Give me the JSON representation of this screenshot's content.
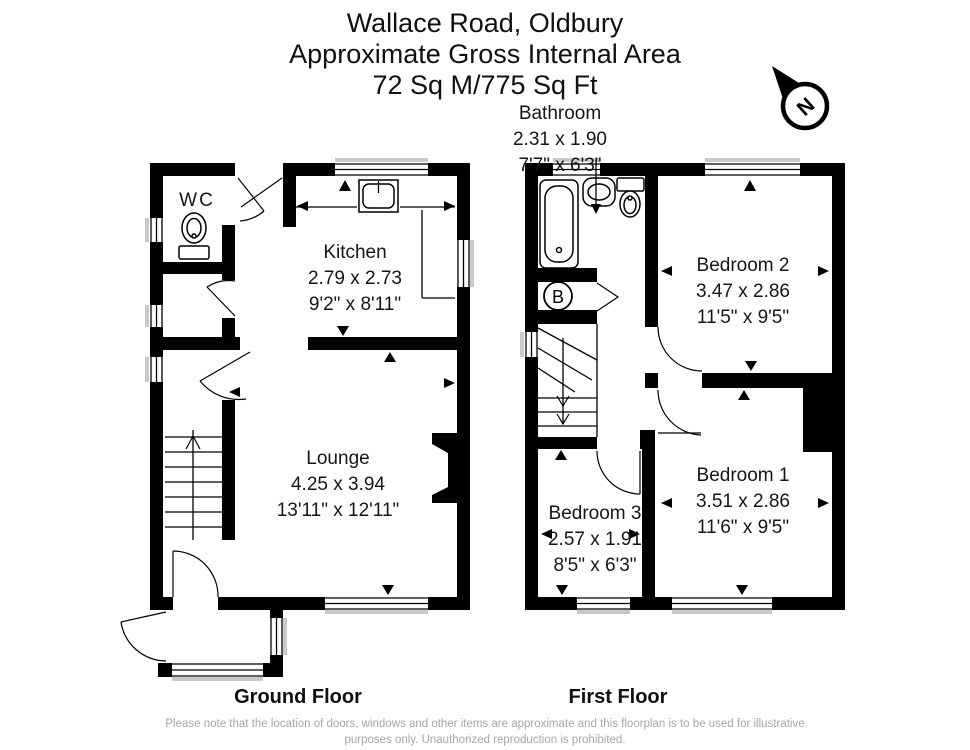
{
  "title": {
    "line1": "Wallace Road, Oldbury",
    "line2": "Approximate Gross Internal Area",
    "line3": "72 Sq M/775 Sq Ft"
  },
  "compass": {
    "label": "N"
  },
  "floors": {
    "ground": {
      "label": "Ground Floor",
      "rooms": {
        "wc": {
          "name": "WC"
        },
        "kitchen": {
          "name": "Kitchen",
          "metric": "2.79 x 2.73",
          "imperial": "9'2\" x 8'11\""
        },
        "lounge": {
          "name": "Lounge",
          "metric": "4.25 x 3.94",
          "imperial": "13'11\" x 12'11\""
        }
      }
    },
    "first": {
      "label": "First Floor",
      "rooms": {
        "bathroom": {
          "name": "Bathroom",
          "metric": "2.31 x 1.90",
          "imperial": "7'7\" x 6'3\""
        },
        "bedroom1": {
          "name": "Bedroom 1",
          "metric": "3.51 x 2.86",
          "imperial": "11'6\" x 9'5\""
        },
        "bedroom2": {
          "name": "Bedroom 2",
          "metric": "3.47 x 2.86",
          "imperial": "11'5\" x 9'5\""
        },
        "bedroom3": {
          "name": "Bedroom 3",
          "metric": "2.57 x 1.91",
          "imperial": "8'5\" x 6'3\""
        },
        "boiler": {
          "label": "B"
        }
      }
    }
  },
  "footer": {
    "line1": "Please note that the location of doors, windows and other items are approximate and this floorplan is to be used for illustrative",
    "line2": "purposes only. Unauthorized reproduction is prohibited."
  },
  "colors": {
    "wall": "#000000",
    "sill": "#c9c9c9",
    "footer_text": "#a6a6a6"
  }
}
